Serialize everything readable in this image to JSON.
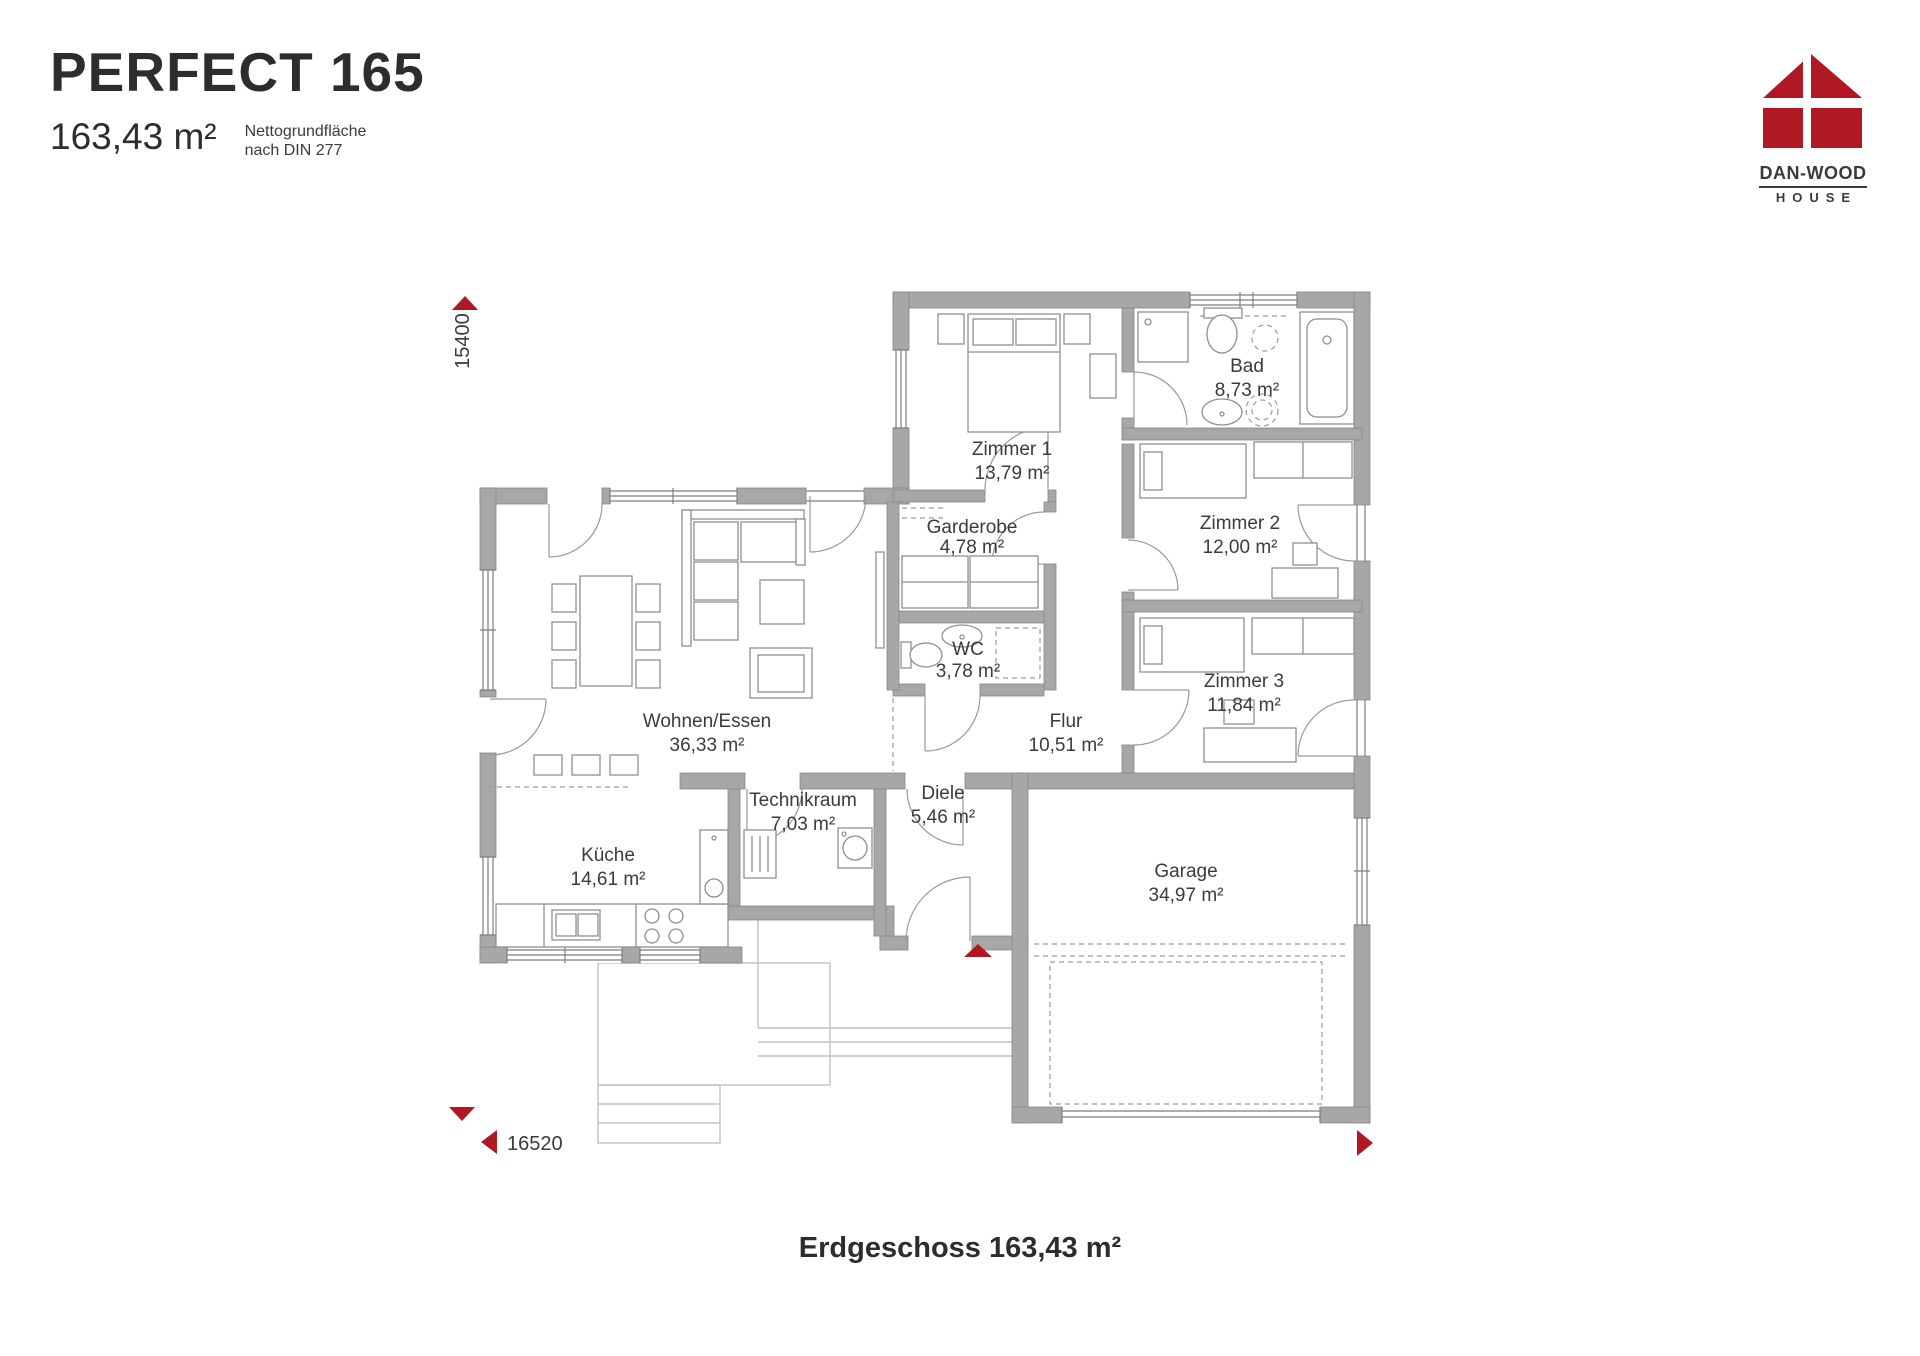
{
  "header": {
    "title": "PERFECT 165",
    "area": "163,43 m²",
    "note_line1": "Nettogrundfläche",
    "note_line2": "nach DIN 277"
  },
  "logo": {
    "brand": "DAN-WOOD",
    "sub": "HOUSE"
  },
  "plan": {
    "rooms": [
      {
        "name": "Zimmer 1",
        "area": "13,79 m²"
      },
      {
        "name": "Bad",
        "area": "8,73 m²"
      },
      {
        "name": "Garderobe",
        "area": "4,78 m²"
      },
      {
        "name": "Zimmer 2",
        "area": "12,00 m²"
      },
      {
        "name": "WC",
        "area": "3,78 m²"
      },
      {
        "name": "Zimmer 3",
        "area": "11,84 m²"
      },
      {
        "name": "Wohnen/Essen",
        "area": "36,33 m²"
      },
      {
        "name": "Flur",
        "area": "10,51 m²"
      },
      {
        "name": "Küche",
        "area": "14,61 m²"
      },
      {
        "name": "Technikraum",
        "area": "7,03 m²"
      },
      {
        "name": "Diele",
        "area": "5,46 m²"
      },
      {
        "name": "Garage",
        "area": "34,97 m²"
      }
    ],
    "dimensions": {
      "height": "15400",
      "width": "16520"
    }
  },
  "footer": {
    "label": "Erdgeschoss 163,43 m²"
  },
  "colors": {
    "wall": "#a7a7a6",
    "accent": "#b01823",
    "text": "#3b3b39"
  }
}
